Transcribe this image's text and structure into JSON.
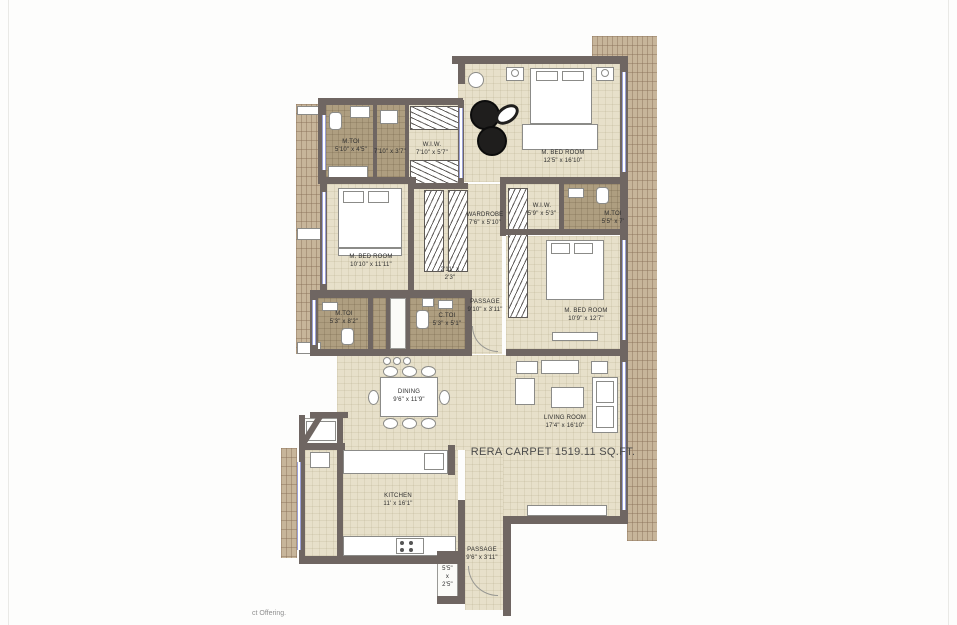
{
  "colors": {
    "wall": "#6f6662",
    "floor_beige": "#e7e0ca",
    "floor_tile": "#ae9e80",
    "deck": "#c7b59a",
    "window_line": "#9aa0d6",
    "label_text": "#2e2e2e"
  },
  "rera_text": "RERA CARPET 1519.11 SQ.FT.",
  "watermark": "ct Offering.",
  "rooms": {
    "mtoi_top": {
      "name": "M.TOI",
      "dim": "5'10\" x 4'5\""
    },
    "lobby_top": {
      "dim": "7'10\" x 3'7\""
    },
    "wiw_top": {
      "name": "W.I.W.",
      "dim": "7'10\" x 5'7\""
    },
    "master_bed_top": {
      "name": "M. BED ROOM",
      "dim": "12'5\" x 16'10\""
    },
    "wardrobe": {
      "name": "WARDROBE",
      "dim": "7'6\" x 5'10\""
    },
    "wiw_right": {
      "name": "W.I.W.",
      "dim": "5'9\" x 5'3\""
    },
    "mtoi_right": {
      "name": "M.TOI",
      "dim": "5'5\" x 7'"
    },
    "bed_left": {
      "name": "M. BED ROOM",
      "dim": "10'10\" x 11'11\""
    },
    "nook_center": {
      "dim1": "2'11\" x",
      "dim2": "2'3\""
    },
    "passage_center": {
      "name": "PASSAGE",
      "dim": "9'10\" x 3'11\""
    },
    "mtoi_bottom": {
      "name": "M.TOI",
      "dim": "5'3\" x 8'2\""
    },
    "ctoi": {
      "name": "C.TOI",
      "dim": "5'3\" x 5'1\""
    },
    "bed_right": {
      "name": "M. BED ROOM",
      "dim": "10'9\" x 12'7\""
    },
    "dining": {
      "name": "DINING",
      "dim": "9'6\" x 11'9\""
    },
    "living": {
      "name": "LIVING ROOM",
      "dim": "17'4\" x 16'10\""
    },
    "kitchen": {
      "name": "KITCHEN",
      "dim": "11' x 16'1\""
    },
    "passage_bottom": {
      "name": "PASSAGE",
      "dim": "9'6\" x 3'11\""
    },
    "nook_bottom": {
      "l1": "5'5\"",
      "l2": "x",
      "l3": "2'5\""
    }
  }
}
